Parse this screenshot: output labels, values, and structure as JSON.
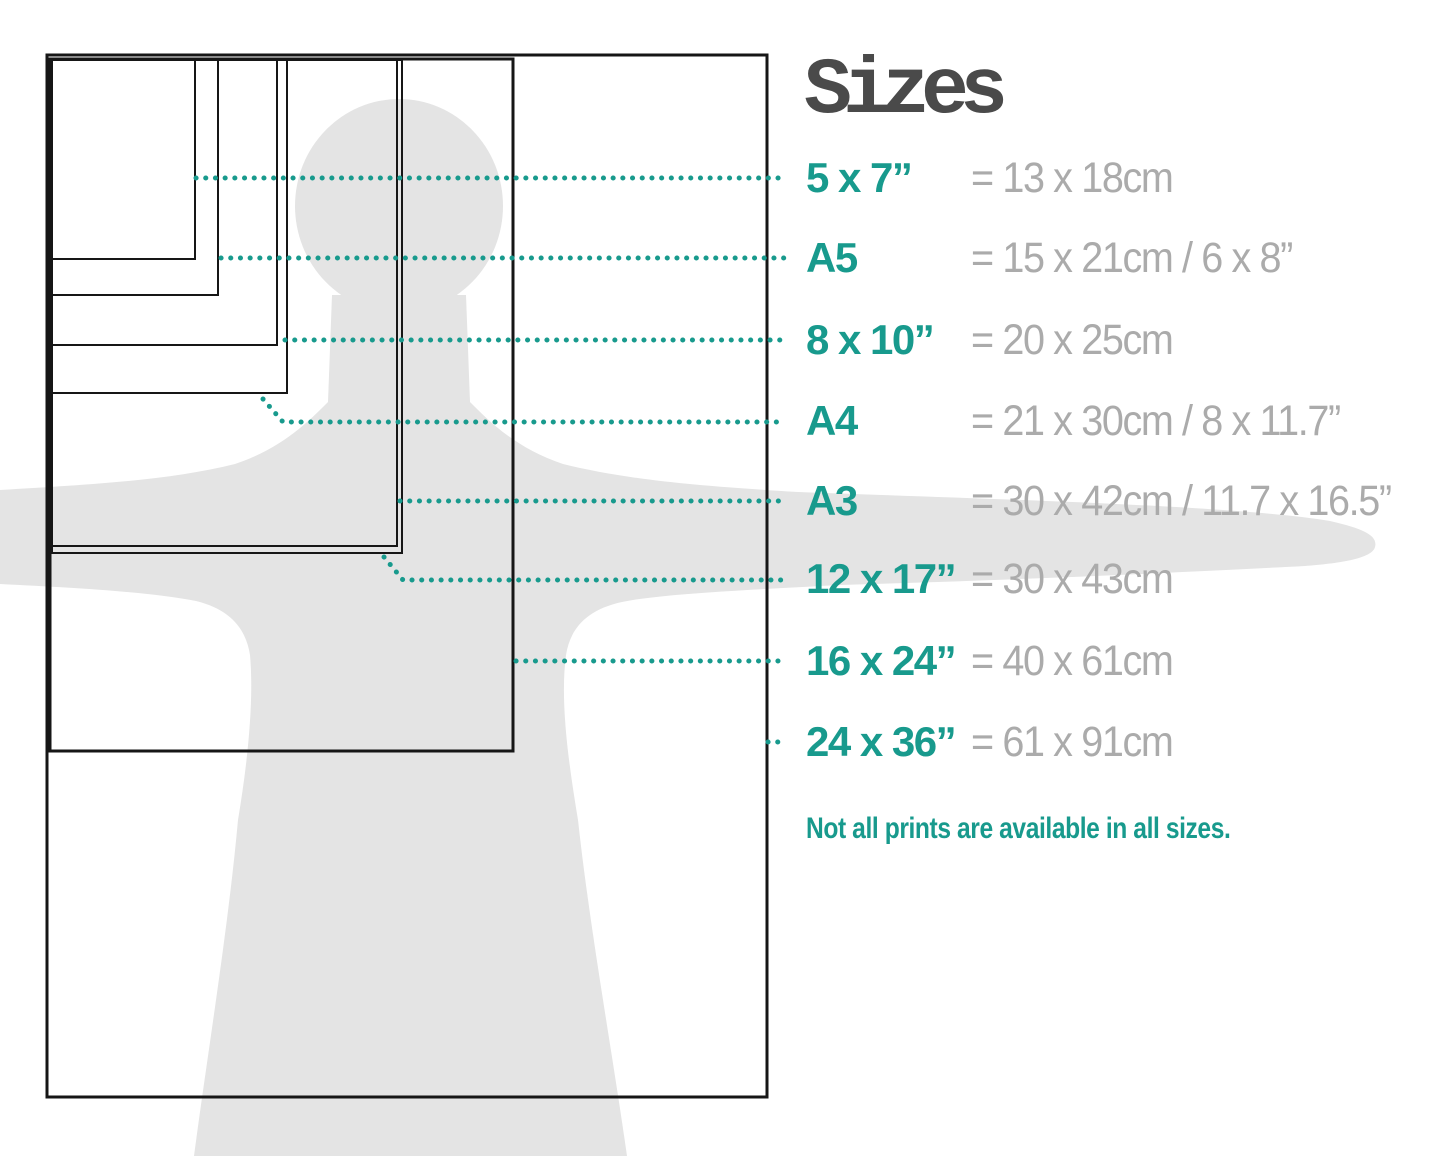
{
  "title": "Sizes",
  "note": "Not all prints are available in all sizes.",
  "colors": {
    "teal": "#189a8d",
    "metric_gray": "#ababab",
    "title_gray": "#4a4a4a",
    "silhouette": "#e4e4e4",
    "outline": "#161616"
  },
  "rows": [
    {
      "id": "5x7",
      "label": "5 x 7”",
      "metric": "= 13 x 18cm",
      "y": 178
    },
    {
      "id": "a5",
      "label": "A5",
      "metric": "= 15 x 21cm / 6 x 8”",
      "y": 258
    },
    {
      "id": "8x10",
      "label": "8 x 10”",
      "metric": "= 20 x 25cm",
      "y": 340
    },
    {
      "id": "a4",
      "label": "A4",
      "metric": "= 21 x 30cm / 8 x 11.7”",
      "y": 421
    },
    {
      "id": "a3",
      "label": "A3",
      "metric": "= 30 x 42cm / 11.7 x 16.5”",
      "y": 501
    },
    {
      "id": "12x17",
      "label": "12 x 17”",
      "metric": "= 30 x 43cm",
      "y": 579
    },
    {
      "id": "16x24",
      "label": "16 x 24”",
      "metric": "= 40 x 61cm",
      "y": 661
    },
    {
      "id": "24x36",
      "label": "24 x 36”",
      "metric": "= 61 x 91cm",
      "y": 742
    }
  ],
  "diagram": {
    "rects": [
      {
        "id": "24x36",
        "x": 47,
        "y": 55,
        "w": 720,
        "h": 1042,
        "sw": 3
      },
      {
        "id": "16x24",
        "x": 50,
        "y": 59,
        "w": 463,
        "h": 692,
        "sw": 3
      },
      {
        "id": "12x17",
        "x": 52,
        "y": 60,
        "w": 350,
        "h": 493,
        "sw": 2
      },
      {
        "id": "a3",
        "x": 52,
        "y": 60,
        "w": 345,
        "h": 486,
        "sw": 2
      },
      {
        "id": "a4",
        "x": 52,
        "y": 60,
        "w": 235,
        "h": 333,
        "sw": 2
      },
      {
        "id": "8x10",
        "x": 52,
        "y": 60,
        "w": 225,
        "h": 285,
        "sw": 2
      },
      {
        "id": "a5",
        "x": 52,
        "y": 60,
        "w": 166,
        "h": 235,
        "sw": 2
      },
      {
        "id": "5x7",
        "x": 52,
        "y": 60,
        "w": 143,
        "h": 199,
        "sw": 2
      }
    ],
    "leaders": [
      {
        "id": "5x7",
        "points": [
          [
            196,
            178
          ],
          [
            786,
            178
          ]
        ]
      },
      {
        "id": "a5",
        "points": [
          [
            221,
            258
          ],
          [
            786,
            258
          ]
        ]
      },
      {
        "id": "8x10",
        "points": [
          [
            285,
            340
          ],
          [
            786,
            340
          ]
        ]
      },
      {
        "id": "a4",
        "points": [
          [
            263,
            399
          ],
          [
            283,
            422
          ],
          [
            786,
            422
          ]
        ]
      },
      {
        "id": "a3",
        "points": [
          [
            400,
            501
          ],
          [
            786,
            501
          ]
        ]
      },
      {
        "id": "12x17",
        "points": [
          [
            384,
            557
          ],
          [
            403,
            580
          ],
          [
            783,
            580
          ]
        ]
      },
      {
        "id": "16x24",
        "points": [
          [
            516,
            661
          ],
          [
            780,
            661
          ]
        ]
      },
      {
        "id": "24x36",
        "points": [
          [
            768,
            742
          ],
          [
            784,
            742
          ]
        ]
      }
    ]
  }
}
